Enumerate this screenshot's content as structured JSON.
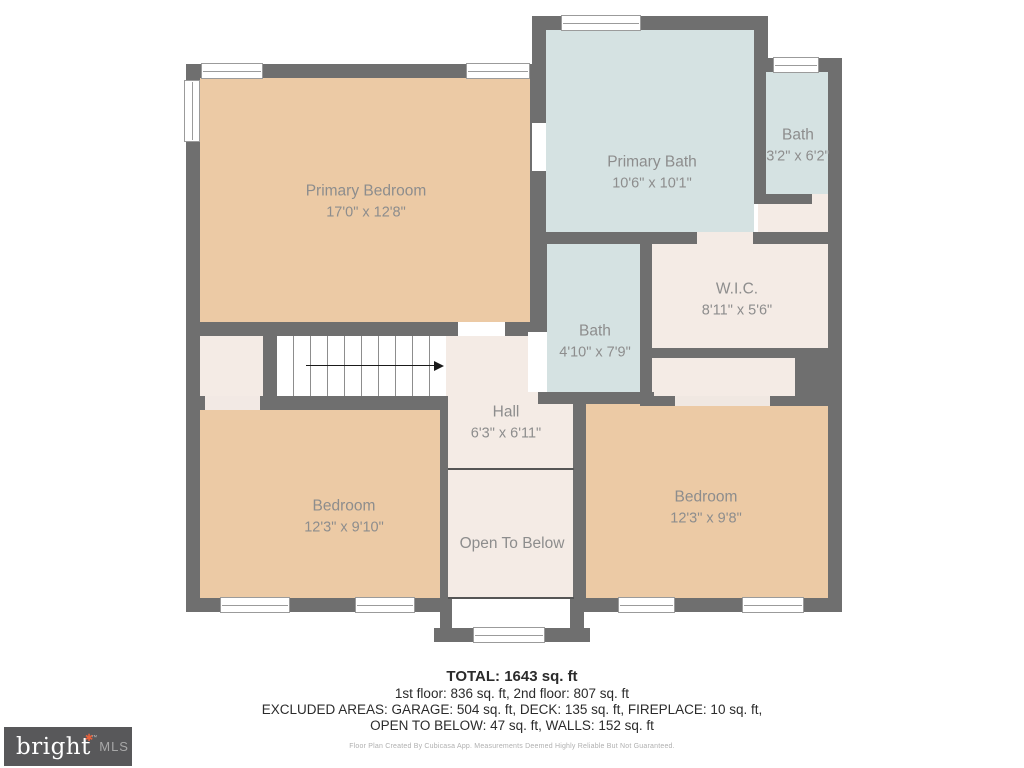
{
  "floorplan": {
    "rooms": {
      "primary_bedroom": {
        "name": "Primary Bedroom",
        "dims": "17'0\" x 12'8\""
      },
      "primary_bath": {
        "name": "Primary Bath",
        "dims": "10'6\" x 10'1\""
      },
      "bath_small": {
        "name": "Bath",
        "dims": "3'2\" x 6'2\""
      },
      "wic": {
        "name": "W.I.C.",
        "dims": "8'11\" x 5'6\""
      },
      "bath_middle": {
        "name": "Bath",
        "dims": "4'10\" x 7'9\""
      },
      "hall": {
        "name": "Hall",
        "dims": "6'3\" x 6'11\""
      },
      "bedroom_left": {
        "name": "Bedroom",
        "dims": "12'3\" x 9'10\""
      },
      "bedroom_right": {
        "name": "Bedroom",
        "dims": "12'3\" x 9'8\""
      },
      "open_to_below": {
        "name": "Open To Below"
      }
    },
    "stairs": {
      "direction": "up-right"
    },
    "colors": {
      "wall": "#6f6f6f",
      "bedroom_fill": "#eccaa5",
      "bath_fill": "#d5e2e2",
      "closet_fill": "#f4ebe5",
      "label_text": "#8d8d8d"
    }
  },
  "summary": {
    "total": "TOTAL: 1643 sq. ft",
    "floors": "1st floor: 836 sq. ft, 2nd floor: 807 sq. ft",
    "excluded_line1": "EXCLUDED AREAS: GARAGE: 504 sq. ft, DECK: 135 sq. ft, FIREPLACE: 10 sq. ft,",
    "excluded_line2": "OPEN TO BELOW: 47 sq. ft, WALLS: 152 sq. ft",
    "disclaimer": "Floor Plan Created By Cubicasa App. Measurements Deemed Highly Reliable But Not Guaranteed."
  },
  "logo": {
    "brand": "bright",
    "star": "✱",
    "tm": "™",
    "suffix": "MLS",
    "colors": {
      "background": "#58585a",
      "brand_text": "#ffffff",
      "star": "#e8613c",
      "suffix_text": "#a8a8a8"
    }
  }
}
